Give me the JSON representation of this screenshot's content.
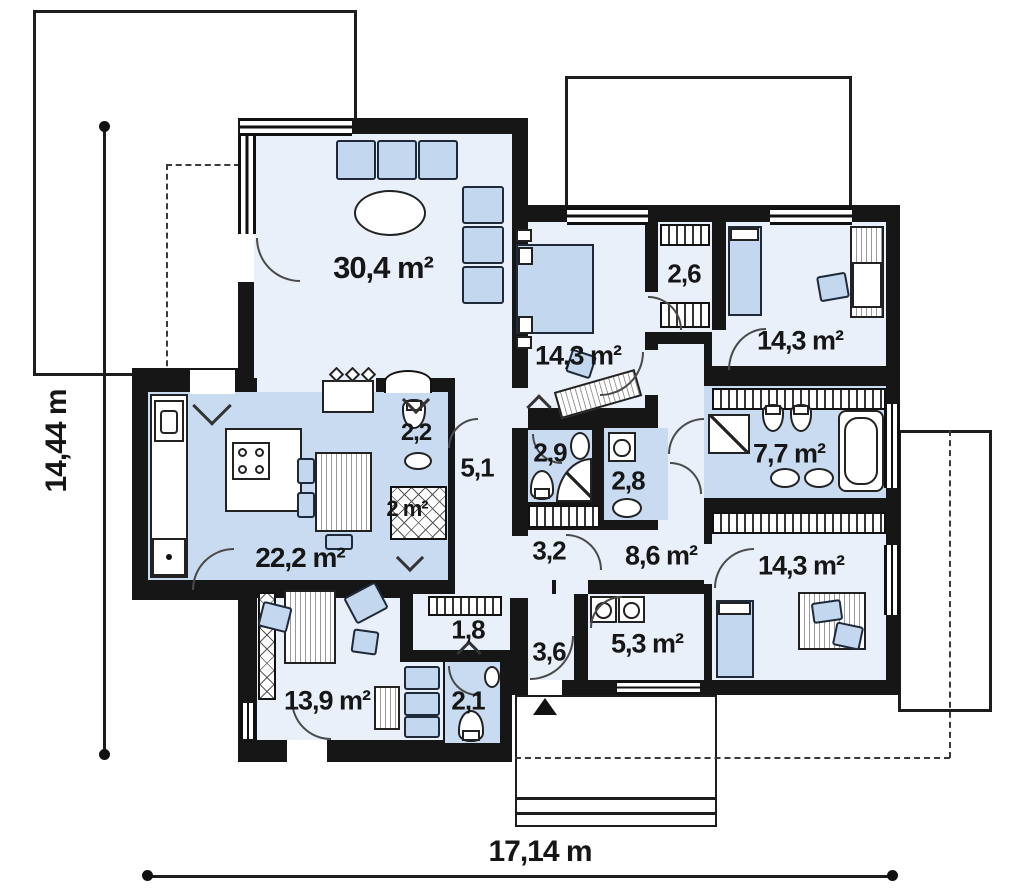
{
  "plan": {
    "type": "single-storey house floor plan",
    "total_width_label": "17,14 m",
    "total_height_label": "14,44 m"
  },
  "rooms": [
    {
      "id": "living-room",
      "label": "30,4 m²"
    },
    {
      "id": "kitchen-dining",
      "label": "22,2 m²"
    },
    {
      "id": "wc-small",
      "label": "2,2"
    },
    {
      "id": "closet-2m",
      "label": "2 m²"
    },
    {
      "id": "hallway",
      "label": "5,1"
    },
    {
      "id": "bedroom-1",
      "label": "14,3 m²"
    },
    {
      "id": "wardrobe-26",
      "label": "2,6"
    },
    {
      "id": "bedroom-2",
      "label": "14,3 m²"
    },
    {
      "id": "bathroom-29",
      "label": "2,9"
    },
    {
      "id": "laundry-wc-28",
      "label": "2,8"
    },
    {
      "id": "bathroom-77",
      "label": "7,7 m²"
    },
    {
      "id": "corridor-32",
      "label": "3,2"
    },
    {
      "id": "hall-86",
      "label": "8,6 m²"
    },
    {
      "id": "bedroom-3",
      "label": "14,3 m²"
    },
    {
      "id": "utility-53",
      "label": "5,3 m²"
    },
    {
      "id": "entry-36",
      "label": "3,6"
    },
    {
      "id": "closet-18",
      "label": "1,8"
    },
    {
      "id": "wc-21",
      "label": "2,1"
    },
    {
      "id": "office",
      "label": "13,9 m²"
    }
  ],
  "dimensions": {
    "height": "14,44 m",
    "width": "17,14 m"
  },
  "colors": {
    "wall": "#161616",
    "room_light": "#e9f0fa",
    "room_dark": "#c9dbf1",
    "furniture": "#c3d7ee",
    "background": "#ffffff"
  }
}
